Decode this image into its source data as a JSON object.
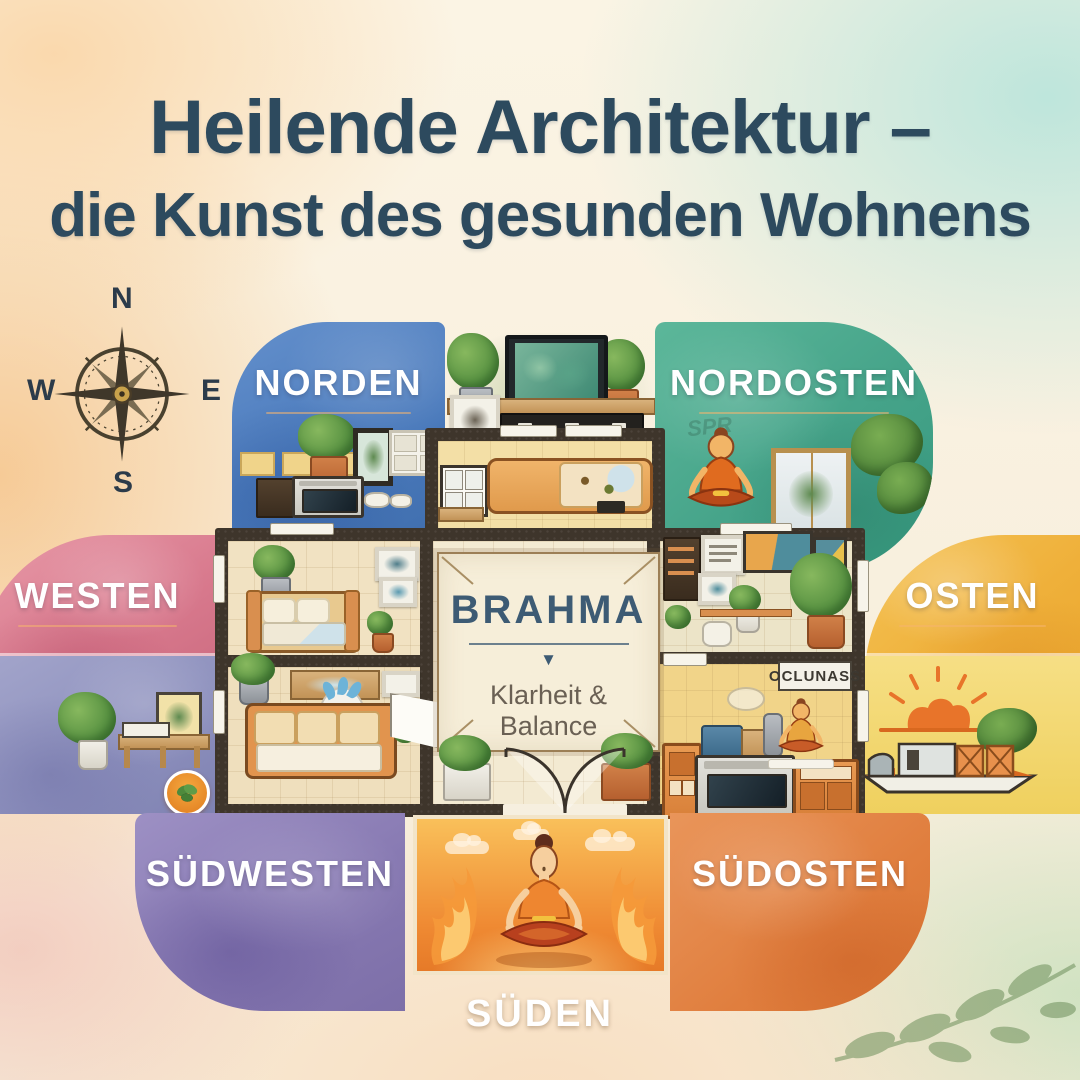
{
  "title": {
    "line1": "Heilende Architektur –",
    "line2": "die Kunst des gesunden Wohnens"
  },
  "compass": {
    "north": "N",
    "east": "E",
    "south": "S",
    "west": "W"
  },
  "zones": {
    "norden": {
      "label": "NORDEN",
      "color": "#4a7abc"
    },
    "nordosten": {
      "label": "NORDOSTEN",
      "color": "#45a389",
      "watermark": "SPR"
    },
    "westen": {
      "label": "WESTEN",
      "color": "#d8798d"
    },
    "osten": {
      "label": "OSTEN",
      "color": "#efb03a"
    },
    "suedwesten": {
      "label": "SÜDWESTEN",
      "color": "#8678b1"
    },
    "suedosten": {
      "label": "SÜDOSTEN",
      "color": "#e07e3e"
    },
    "sueden": {
      "label": "SÜDEN",
      "color": "#f5e2cd"
    }
  },
  "center_panel": {
    "title": "BRAHMA",
    "arrow": "▼",
    "subtitle": "Klarheit & Balance"
  },
  "plan_signs": {
    "kitchen_plaque": "OCLUNASS"
  },
  "palette": {
    "title_text": "#2d4a5e",
    "wall": "#3e352b",
    "zone_label_text": "#ffffff",
    "panel_bg": "#f6eed9",
    "panel_text": "#3d5b74",
    "panel_subtitle_text": "#6a6054",
    "flame_orange": "#ef8a33"
  }
}
